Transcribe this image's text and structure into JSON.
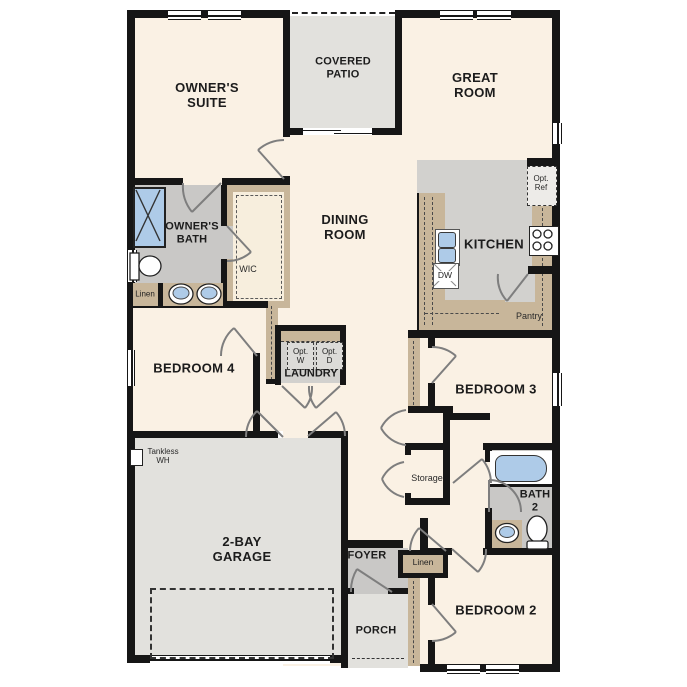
{
  "title": "Single-story floor plan",
  "colors": {
    "floor_cream": "#faf1e4",
    "patio_garage_gray": "#e2e1dd",
    "bath_foyer_gray": "#c9c8c6",
    "kitchen_gray": "#d2d1ce",
    "cabinet_tan": "#c8b69a",
    "fixture_blue": "#aecbe8",
    "wall_black": "#161616"
  },
  "rooms": {
    "owners_suite": "OWNER'S\nSUITE",
    "covered_patio": "COVERED\nPATIO",
    "great_room": "GREAT\nROOM",
    "dining_room": "DINING\nROOM",
    "kitchen": "KITCHEN",
    "owners_bath": "OWNER'S\nBATH",
    "wic": "WIC",
    "linen_bath": "Linen",
    "bedroom4": "BEDROOM 4",
    "laundry": "LAUNDRY",
    "bedroom3": "BEDROOM 3",
    "garage": "2-BAY\nGARAGE",
    "storage": "Storage",
    "bath2": "BATH\n2",
    "foyer": "FOYER",
    "linen_hall": "Linen",
    "porch": "PORCH",
    "bedroom2": "BEDROOM 2",
    "pantry": "Pantry"
  },
  "fixtures": {
    "tankless": "Tankless\nWH",
    "opt_washer": "Opt.\nW",
    "opt_dryer": "Opt.\nD",
    "opt_ref": "Opt.\nRef",
    "dishwasher": "DW"
  }
}
